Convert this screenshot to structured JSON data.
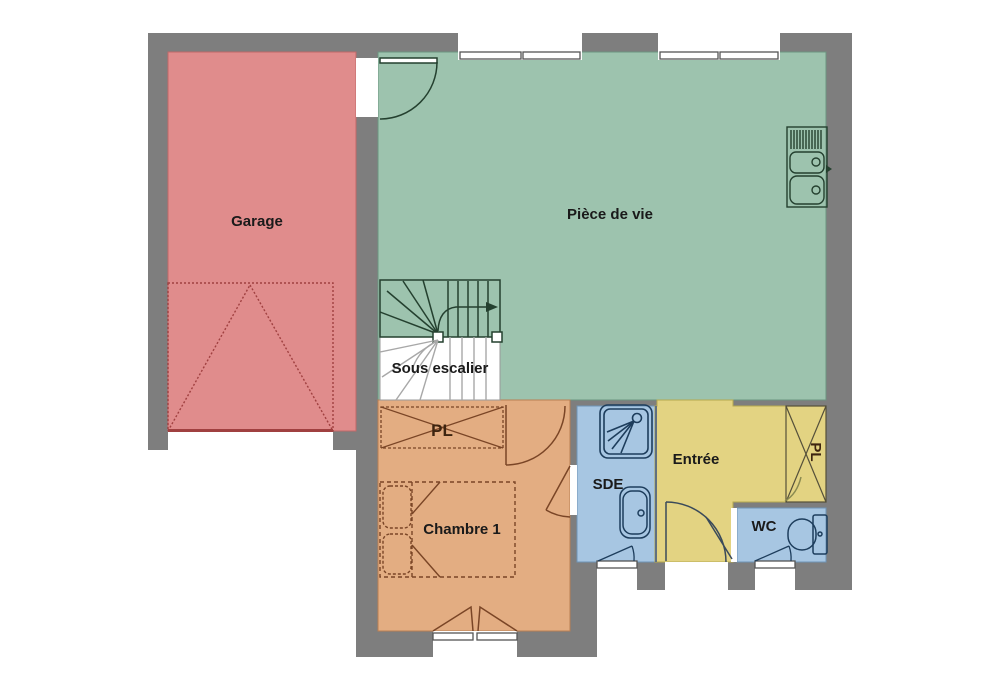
{
  "plan": {
    "rooms": {
      "garage": {
        "label": "Garage",
        "color": "#e08c8c"
      },
      "living": {
        "label": "Pièce de vie",
        "color": "#9dc3ae"
      },
      "under_stairs": {
        "label": "Sous escalier",
        "color": "#ffffff"
      },
      "hall_closet": {
        "label": "PL",
        "color": "#e3ad82"
      },
      "bedroom": {
        "label": "Chambre 1",
        "color": "#e3ad82"
      },
      "shower_room": {
        "label": "SDE",
        "color": "#a7c6e2"
      },
      "entry": {
        "label": "Entrée",
        "color": "#e3d382"
      },
      "wc": {
        "label": "WC",
        "color": "#a7c6e2"
      },
      "entry_closet": {
        "label": "PL",
        "color": "#e3d382"
      }
    },
    "colors": {
      "wall": "#7e7e7e",
      "opening": "#ffffff",
      "stair_line": "#24402f",
      "under_stair_line": "#a8a8a8",
      "bath_line": "#1d3d5c",
      "furniture_line": "#7a4526",
      "garage_door_line": "#a04040",
      "front_door_line": "#3a4a5a",
      "window_frame": "#555555"
    },
    "icons": [
      "stairs-icon",
      "garage-door-icon",
      "bed-icon",
      "shower-icon",
      "washbasin-icon",
      "toilet-icon",
      "kitchen-sink-icon",
      "door-swing-icon",
      "window-icon",
      "post-icon"
    ]
  }
}
